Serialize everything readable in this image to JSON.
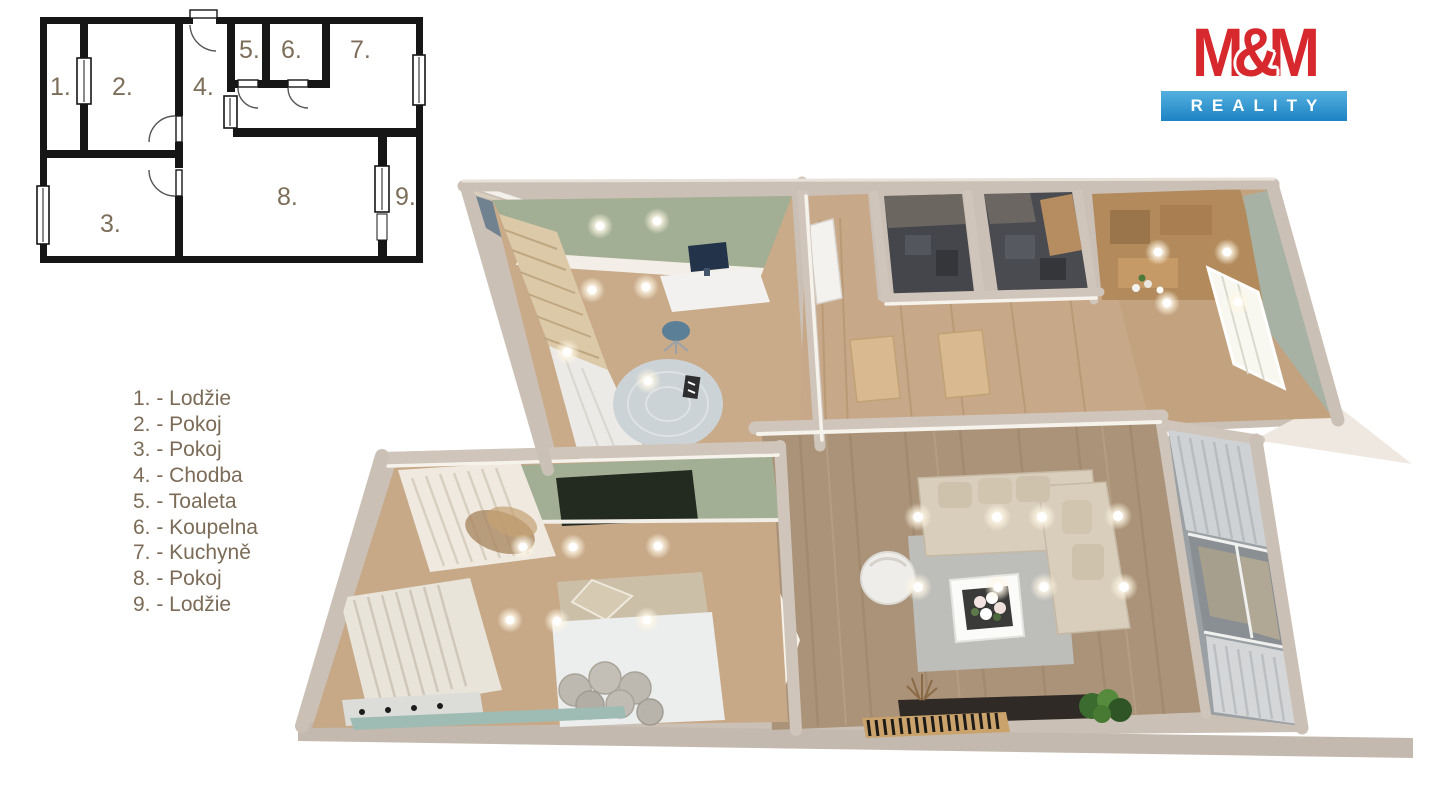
{
  "logo": {
    "m1": "M",
    "amp": "&",
    "m2": "M",
    "reality": "REALITY",
    "colors": {
      "red": "#d7282e",
      "blue_top": "#55b0e0",
      "blue_bottom": "#1d83c3"
    }
  },
  "plan2d": {
    "room_numbers": [
      "1.",
      "2.",
      "3.",
      "4.",
      "5.",
      "6.",
      "7.",
      "8.",
      "9."
    ]
  },
  "legend": {
    "items": [
      "1. - Lodžie",
      "2. - Pokoj",
      "3. - Pokoj",
      "4. - Chodba",
      "5. - Toaleta",
      "6. - Koupelna",
      "7. - Kuchyně",
      "8. - Pokoj",
      "9. - Lodžie"
    ]
  },
  "colors": {
    "legend_text": "#7b6b57",
    "plan_lines": "#161616",
    "wall_beige": "#cbc0b6",
    "floor_wood": "#c7a888",
    "living_wood": "#ab9379",
    "sage_green": "#a2af94",
    "dark_tile": "#45464b",
    "rug_gray": "#bdbdba",
    "sofa_beige": "#d9cebc",
    "loggia_blue": "#70818f"
  }
}
